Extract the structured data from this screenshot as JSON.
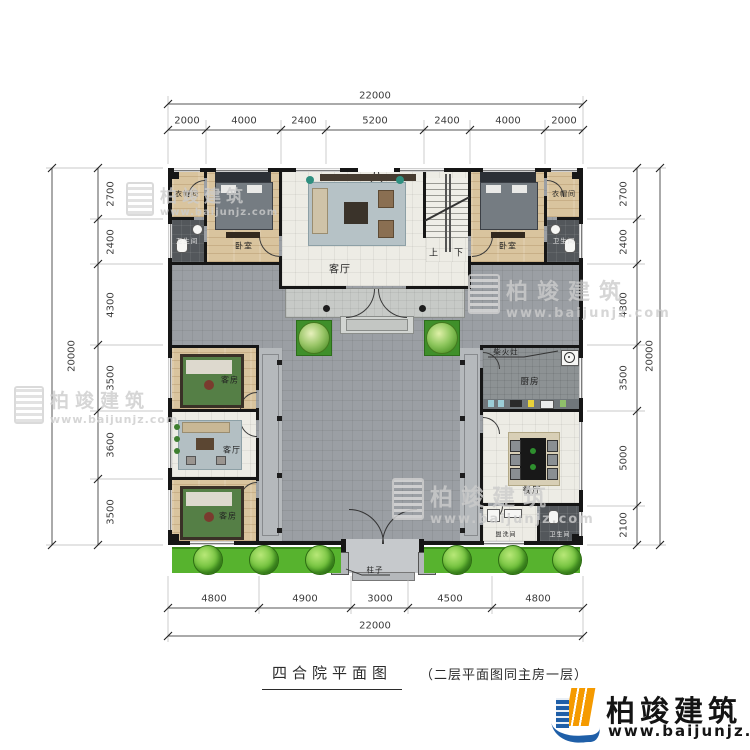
{
  "title": {
    "main": "四合院平面图",
    "sub": "（二层平面图同主房一层）"
  },
  "brand": {
    "name": "柏竣建筑",
    "url": "www.baijunjz.com"
  },
  "watermark": {
    "name": "柏竣建筑",
    "url": "www.baijunjz.com"
  },
  "dims": {
    "top_total": "22000",
    "top": [
      "2000",
      "4000",
      "2400",
      "5200",
      "2400",
      "4000",
      "2000"
    ],
    "bottom": [
      "4800",
      "4900",
      "3000",
      "4500",
      "4800"
    ],
    "bottom_total": "22000",
    "left_total": "20000",
    "left": [
      "2700",
      "2400",
      "4300",
      "3500",
      "3600",
      "3500"
    ],
    "right": [
      "2700",
      "2400",
      "4300",
      "3500",
      "5000",
      "2100"
    ],
    "right_total": "20000"
  },
  "rooms": {
    "cloak_nw": "衣帽间",
    "bath_nw": "卫生间",
    "bed_nw": "卧室",
    "hall": "客厅",
    "up": "上",
    "down": "下",
    "bed_ne": "卧室",
    "cloak_ne": "衣帽间",
    "bath_ne": "卫生间",
    "guest_w1": "客房",
    "living_w": "客厅",
    "guest_w2": "客房",
    "stove": "柴火灶",
    "kitchen": "厨房",
    "dining": "餐厅",
    "wash": "盥洗间",
    "bath_se": "卫生间",
    "pillar": "柱子"
  }
}
